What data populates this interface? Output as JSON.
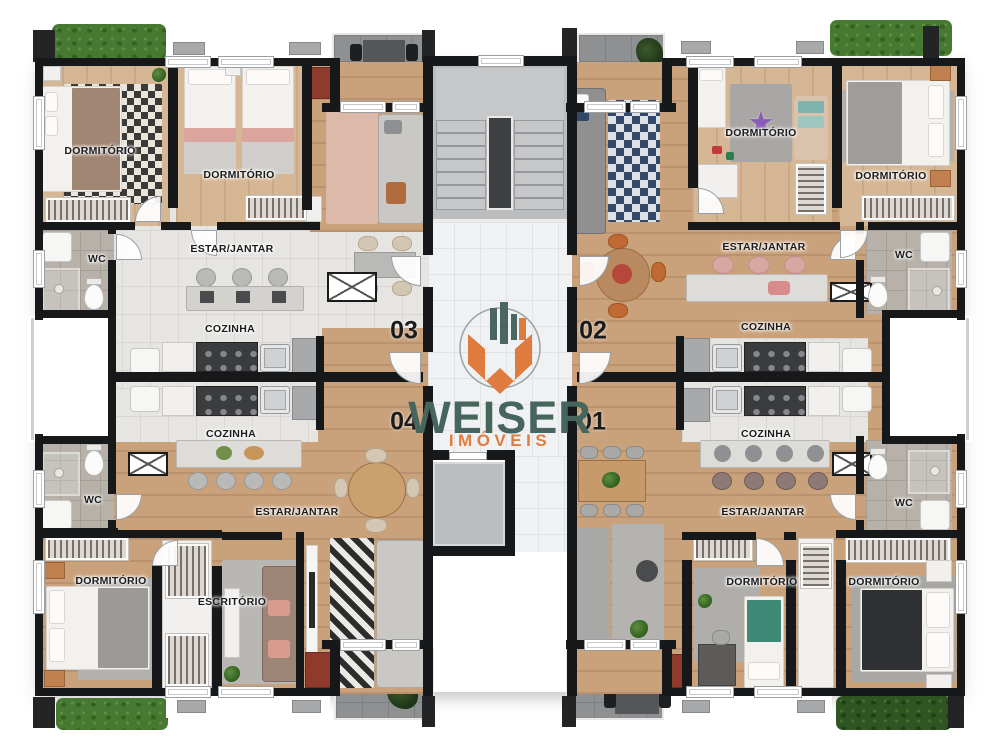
{
  "brand": {
    "name": "WEISER",
    "tagline": "IMÓVEIS",
    "colors": {
      "name_text": "#46655c",
      "tagline_text": "#e07c3e",
      "mark_teal": "#4a665e",
      "mark_orange": "#df7b3e"
    }
  },
  "icons": {
    "star_rug": "★"
  },
  "units": {
    "u03": {
      "number": "03",
      "rooms": {
        "dorm1": "DORMITÓRIO",
        "dorm2": "DORMITÓRIO",
        "living": "ESTAR/JANTAR",
        "kitchen": "COZINHA",
        "wc": "WC"
      }
    },
    "u02": {
      "number": "02",
      "rooms": {
        "dorm1": "DORMITÓRIO",
        "dorm2": "DORMITÓRIO",
        "living": "ESTAR/JANTAR",
        "kitchen": "COZINHA",
        "wc": "WC"
      }
    },
    "u04": {
      "number": "04",
      "rooms": {
        "dorm1": "DORMITÓRIO",
        "office": "ESCRITÓRIO",
        "living": "ESTAR/JANTAR",
        "kitchen": "COZINHA",
        "wc": "WC"
      }
    },
    "u01": {
      "number": "01",
      "rooms": {
        "dorm1": "DORMITÓRIO",
        "dorm2": "DORMITÓRIO",
        "living": "ESTAR/JANTAR",
        "kitchen": "COZINHA",
        "wc": "WC"
      }
    }
  }
}
